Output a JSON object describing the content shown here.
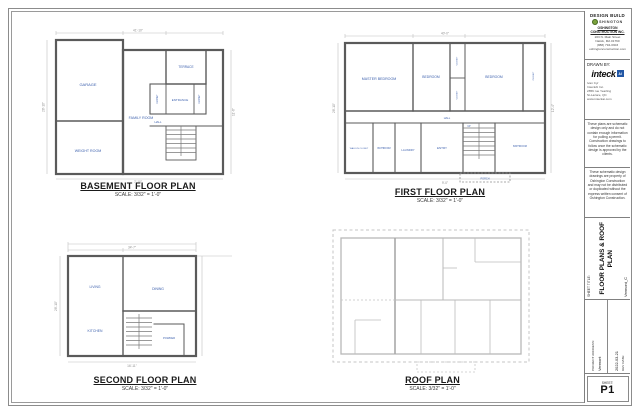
{
  "colors": {
    "room_label_blue": "#3f62ae",
    "wall_gray": "#5a5a5a",
    "roof_gray": "#bdbdbd",
    "logo_green": "#7aa23c",
    "logo_blue": "#2257a5"
  },
  "plans": {
    "basement": {
      "title": "BASEMENT FLOOR PLAN",
      "scale": "SCALE: 3/32\" = 1'-0\"",
      "rooms": {
        "garage": "GARAGE",
        "family": "FAMILY ROOM",
        "weight": "WEIGHT ROOM",
        "terrace": "TERRACE",
        "entrance": "ENTRANCE",
        "hall": "HALL",
        "closet1": "CLOSET",
        "closet2": "CLOSET"
      },
      "dims": [
        "41'-10\"",
        "28'-10\"",
        "11'-6\"",
        "7'-10\""
      ]
    },
    "first": {
      "title": "FIRST FLOOR PLAN",
      "scale": "SCALE: 3/32\" = 1'-0\"",
      "rooms": {
        "master": "MASTER BEDROOM",
        "bedroom2": "BEDROOM",
        "bedroom3": "BEDROOM",
        "closet1": "CLOSET",
        "closet2": "CLOSET",
        "closet3": "CLOSET",
        "hall": "HALL",
        "wic": "WALK-IN CLOSET",
        "bath1": "BATHROOM",
        "laundry": "LAUNDRY",
        "entry": "ENTRY",
        "bath2": "BATHROOM",
        "up": "UP",
        "porch": "PORCH"
      },
      "dims": [
        "40'-0\"",
        "28'-10\"",
        "12'-4\"",
        "9'-0\""
      ]
    },
    "second": {
      "title": "SECOND FLOOR PLAN",
      "scale": "SCALE: 3/32\" = 1'-0\"",
      "rooms": {
        "living": "LIVING",
        "dining": "DINING",
        "kitchen": "KITCHEN",
        "powder": "POWDER"
      },
      "dims": [
        "34'-7\"",
        "28'-10\"",
        "16'-11\""
      ]
    },
    "roof": {
      "title": "ROOF PLAN",
      "scale": "SCALE: 3/32\" = 1'-0\""
    }
  },
  "title_block": {
    "company": {
      "line1": "DESIGN BUILD",
      "logo_text": "SHINGTON",
      "name": "OSHINGTON CONSTRUCTION INC.",
      "lines": [
        "203 N. Main Street",
        "Natick, MA 01760",
        "(888) 794-0303",
        "oshingtonconstruction.com"
      ]
    },
    "drawn_by": {
      "label": "DRAWN BY:",
      "logo": "inteck",
      "logo_badge": "AI",
      "lines": [
        "Ivan Cyr",
        "InteckAI Inc.",
        "2856 rue Yearling",
        "St-Lazare, QC",
        "www.inteckai.com"
      ]
    },
    "disclaimer1": "These plans are schematic design only and do not contain enough information for pulling a permit. Construction drawings to follow once the schematic design is approved by the clients.",
    "disclaimer2": "These schematic design drawings are property of Oshington Construction and may not be distributed or duplicated without the express written consent of Oshington Construction.",
    "sheet_title_label": "SHEET TITLE:",
    "sheet_title_line1": "FLOOR PLANS & ROOF",
    "sheet_title_line2": "PLAN",
    "sheet_subtitle": "Vermont_C",
    "project_address_label": "PROJECT ADDRESS:",
    "project_address": "Vermont",
    "rev_date_label": "REV DATE:",
    "rev_date": "2022-03-21",
    "sheet_label": "SHEET:",
    "sheet_number": "P1"
  }
}
